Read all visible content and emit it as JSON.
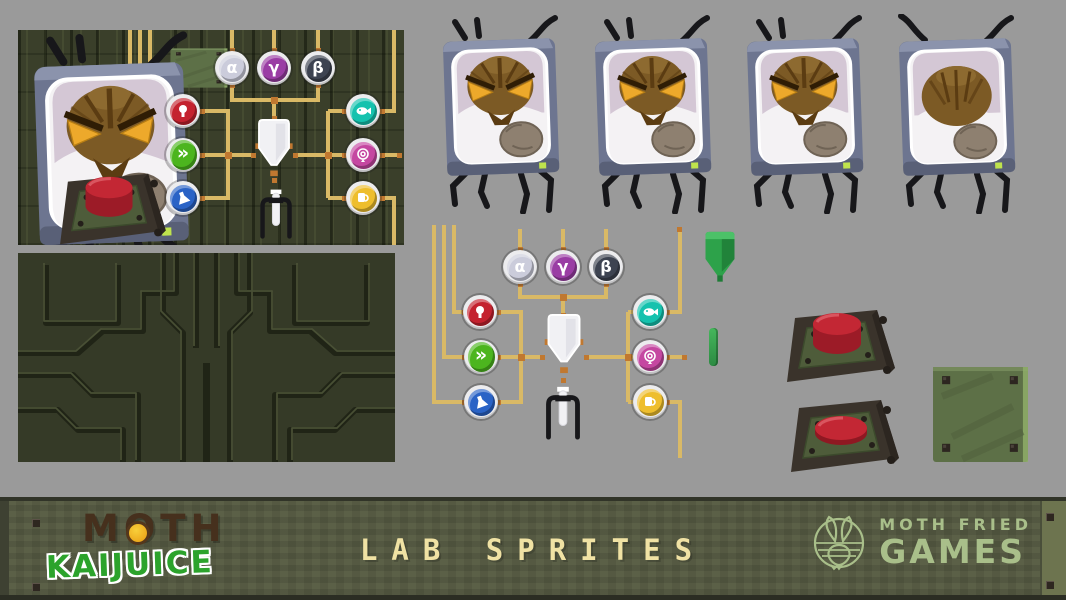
{
  "banner": {
    "title": "LAB SPRITES",
    "logo": {
      "moth": "MOTH",
      "kaijuice": "KAIJUICE"
    },
    "studio": {
      "line1": "MOTH FRIED",
      "line2": "GAMES"
    }
  },
  "badges": {
    "alpha": {
      "glyph": "α",
      "color": "#cbccdb"
    },
    "gamma": {
      "glyph": "γ",
      "color": "#9a3da4"
    },
    "beta": {
      "glyph": "β",
      "color": "#3d4351"
    },
    "bulb": {
      "color": "#c4222f"
    },
    "fastforward": {
      "glyph": "»",
      "color": "#4cb51e"
    },
    "flask": {
      "color": "#2a63c6"
    },
    "fish": {
      "color": "#15c2ae"
    },
    "rose": {
      "color": "#c547a1"
    },
    "cup": {
      "color": "#eebe2d"
    }
  },
  "sprites": {
    "monitor_count": 4,
    "items": [
      "moth-monitor",
      "red-button-up",
      "red-button-pressed",
      "green-panel-plate",
      "white-funnel-bag",
      "green-funnel-bag",
      "test-tube-stand",
      "green-rod",
      "wire-network",
      "circuit-texture"
    ]
  },
  "colors": {
    "background": "#9a9a9a",
    "panel_green": "#353a27",
    "banner_green": "#5b6047",
    "wire": "#d9b966",
    "wire_node": "#c07830",
    "title_text": "#f0e2a4",
    "studio_text": "#a9bf8a",
    "kaijuice_green": "#2ca32c",
    "moth_brown": "#46301d",
    "button_red": "#c32734",
    "bezel_gray": "#6d7590",
    "eye_amber": "#eda92b"
  }
}
